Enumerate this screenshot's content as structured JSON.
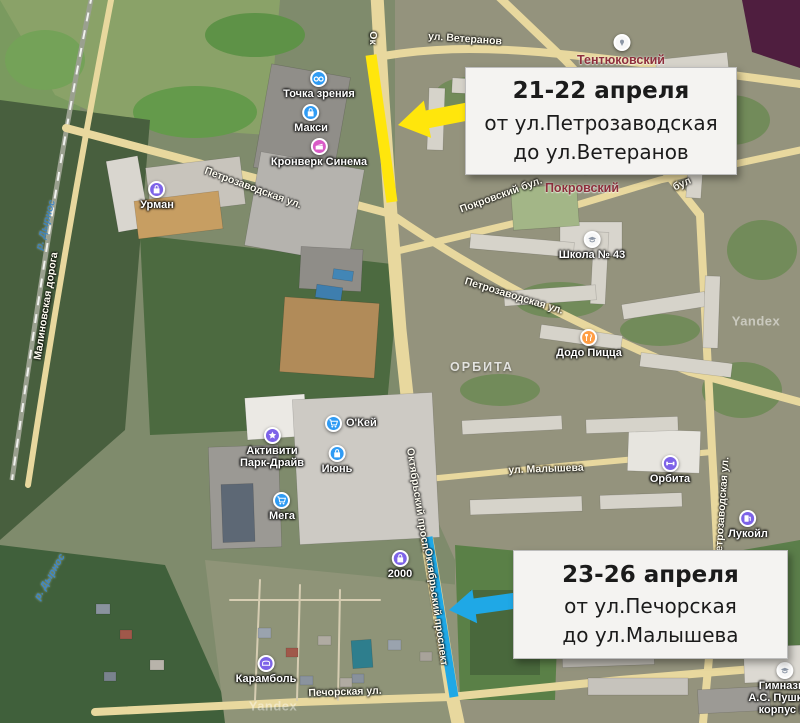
{
  "map": {
    "callouts": [
      {
        "title": "21-22 апреля",
        "line1": "от ул.Петрозаводская",
        "line2": "до ул.Ветеранов"
      },
      {
        "title": "23-26 апреля",
        "line1": "от ул.Печорская",
        "line2": "до ул.Малышева"
      }
    ],
    "pois": [
      {
        "label": "Точка зрения"
      },
      {
        "label": "Макси"
      },
      {
        "label": "Кронверк Синема"
      },
      {
        "label": "Урман"
      },
      {
        "label": "Додо Пицца"
      },
      {
        "label": "Школа № 43"
      },
      {
        "label": "Орбита"
      },
      {
        "label": "Лукойл"
      },
      {
        "label": "О'Кей"
      },
      {
        "label": "Июнь"
      },
      {
        "label": "Мега"
      },
      {
        "label1": "Активити",
        "label2": "Парк-Драйв"
      },
      {
        "label": "2000"
      },
      {
        "label": "Карамболь"
      },
      {
        "label1": "Гимназия",
        "label2": "А.С. Пушкина",
        "label3": "корпус №"
      },
      {
        "label": ""
      }
    ],
    "streets": [
      {
        "label": "ул. Ветеранов"
      },
      {
        "label": "Ок"
      },
      {
        "label": "Петрозаводская ул."
      },
      {
        "label": "Покровский бул."
      },
      {
        "label": "бул"
      },
      {
        "label": "Петрозаводская ул."
      },
      {
        "label": "ул. Малышева"
      },
      {
        "label": "Октябрьский просп."
      },
      {
        "label": "Октябрьский проспект"
      },
      {
        "label": "Печорская ул."
      },
      {
        "label": "Петрозаводская ул."
      },
      {
        "label": "Малиновская дорога"
      }
    ],
    "districts": [
      {
        "label": "Тентюковский"
      },
      {
        "label": "Покровский"
      }
    ],
    "areas": [
      {
        "label": "ОРБИТА"
      }
    ],
    "rivers": [
      {
        "label": "р. Дырнос"
      },
      {
        "label": "р. Дырнос"
      }
    ],
    "watermarks": [
      {
        "label": "Yandex"
      },
      {
        "label": "Yandex"
      }
    ]
  },
  "colors": {
    "highlight_yellow": "#FFE60C",
    "highlight_blue": "#1FA8E6",
    "poi_blue": "#2F9BF4",
    "poi_purple": "#7D63E8",
    "poi_pink": "#D95BC6",
    "poi_orange": "#FF9E45",
    "poi_white": "#F7F7F7",
    "district_label": "#8E2F3C",
    "callout_bg": "#F4F3F1"
  }
}
